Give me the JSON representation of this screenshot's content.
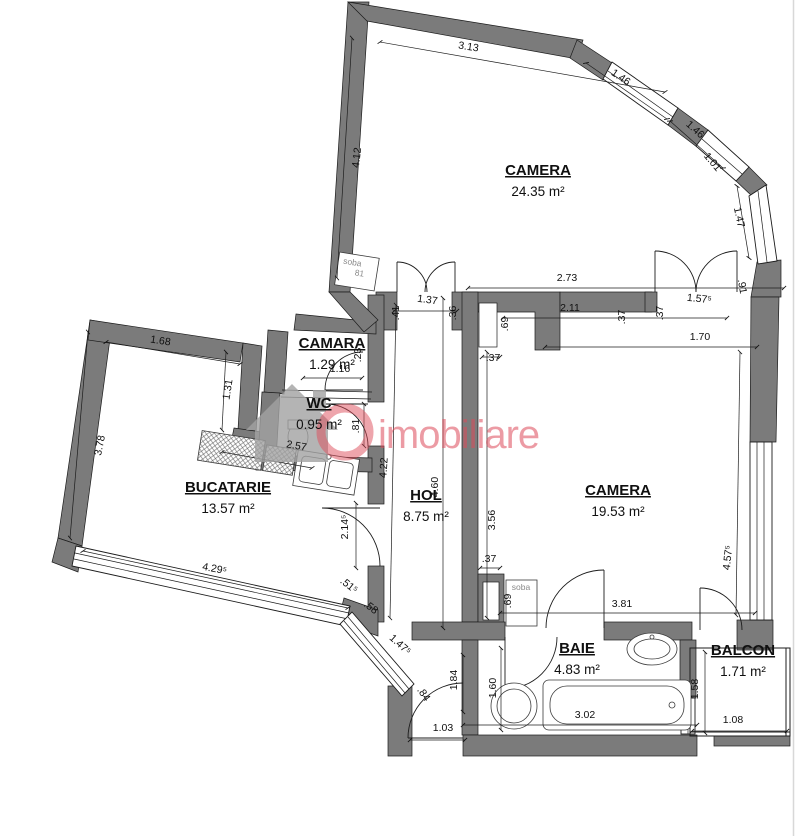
{
  "colors": {
    "wall": "#7b7b7b",
    "line": "#1c1c1c",
    "wm": "#de4b5a",
    "wmhouse": "#a2a2a2",
    "border": "#d8d8d8"
  },
  "plan": {
    "rooms": [
      {
        "name": "CAMERA",
        "area": "24.35 m²",
        "cx": 538,
        "cy": 175
      },
      {
        "name": "CAMARA",
        "area": "1.29 m²",
        "cx": 332,
        "cy": 348
      },
      {
        "name": "WC",
        "area": "0.95 m²",
        "cx": 319,
        "cy": 408
      },
      {
        "name": "BUCATARIE",
        "area": "13.57 m²",
        "cx": 228,
        "cy": 492
      },
      {
        "name": "HOL",
        "area": "8.75 m²",
        "cx": 426,
        "cy": 500
      },
      {
        "name": "CAMERA",
        "area": "19.53 m²",
        "cx": 618,
        "cy": 495
      },
      {
        "name": "BAIE",
        "area": "4.83 m²",
        "cx": 577,
        "cy": 653
      },
      {
        "name": "BALCON",
        "area": "1.71 m²",
        "cx": 743,
        "cy": 655
      }
    ],
    "dimensions": [
      {
        "v": "3.13",
        "x": 468,
        "y": 50,
        "r": 9
      },
      {
        "v": "4.12",
        "x": 360,
        "y": 158,
        "r": -84
      },
      {
        "v": "1.46",
        "x": 619,
        "y": 80,
        "r": 34
      },
      {
        "v": "1.46",
        "x": 693,
        "y": 132,
        "r": 42
      },
      {
        "v": "1.01",
        "x": 710,
        "y": 164,
        "r": 50
      },
      {
        "v": "1.47",
        "x": 736,
        "y": 218,
        "r": 78
      },
      {
        "v": ".91",
        "x": 739,
        "y": 287,
        "r": 80
      },
      {
        "v": "2.73",
        "x": 567,
        "y": 281,
        "r": 0
      },
      {
        "v": "1.37",
        "x": 427,
        "y": 303,
        "r": 8
      },
      {
        "v": ".41",
        "x": 399,
        "y": 313,
        "r": -90
      },
      {
        "v": ".36",
        "x": 456,
        "y": 313,
        "r": -90
      },
      {
        "v": "2.11",
        "x": 570,
        "y": 311,
        "r": 0
      },
      {
        "v": ".69",
        "x": 508,
        "y": 324,
        "r": -90
      },
      {
        "v": ".37",
        "x": 625,
        "y": 317,
        "r": -90
      },
      {
        "v": ".37",
        "x": 663,
        "y": 313,
        "r": -90
      },
      {
        "v": "1.57⁵",
        "x": 699,
        "y": 302,
        "r": 6
      },
      {
        "v": "1.70",
        "x": 700,
        "y": 340,
        "r": 0
      },
      {
        "v": ".37",
        "x": 493,
        "y": 361,
        "r": 0
      },
      {
        "v": "3.56",
        "x": 495,
        "y": 520,
        "r": -90
      },
      {
        "v": "4.57⁵",
        "x": 731,
        "y": 558,
        "r": -84
      },
      {
        "v": "3.81",
        "x": 622,
        "y": 607,
        "r": 0
      },
      {
        "v": ".37",
        "x": 489,
        "y": 562,
        "r": 0
      },
      {
        "v": ".69",
        "x": 511,
        "y": 601,
        "r": -90
      },
      {
        "v": "1.68",
        "x": 160,
        "y": 344,
        "r": 9
      },
      {
        "v": "1.31",
        "x": 231,
        "y": 390,
        "r": -81
      },
      {
        "v": "3.78",
        "x": 103,
        "y": 446,
        "r": -79
      },
      {
        "v": "2.57",
        "x": 296,
        "y": 449,
        "r": 10
      },
      {
        "v": "4.29⁵",
        "x": 214,
        "y": 572,
        "r": 11
      },
      {
        "v": "2.14⁵",
        "x": 348,
        "y": 527,
        "r": -90
      },
      {
        "v": ".51⁵",
        "x": 347,
        "y": 588,
        "r": 38
      },
      {
        "v": ".58",
        "x": 369,
        "y": 610,
        "r": 38
      },
      {
        "v": "1.47⁵",
        "x": 398,
        "y": 647,
        "r": 42
      },
      {
        "v": ".84",
        "x": 421,
        "y": 696,
        "r": 55
      },
      {
        "v": "1.03",
        "x": 443,
        "y": 731,
        "r": 0
      },
      {
        "v": "1.84",
        "x": 457,
        "y": 680,
        "r": -90
      },
      {
        "v": "1.60",
        "x": 496,
        "y": 688,
        "r": -90
      },
      {
        "v": "3.02",
        "x": 585,
        "y": 718,
        "r": 0
      },
      {
        "v": "1.58",
        "x": 698,
        "y": 689,
        "r": -90
      },
      {
        "v": "1.08",
        "x": 733,
        "y": 723,
        "r": 0
      },
      {
        "v": "4.22",
        "x": 387,
        "y": 468,
        "r": -86
      },
      {
        "v": "4.60",
        "x": 438,
        "y": 487,
        "r": -90
      },
      {
        "v": "1.16",
        "x": 340,
        "y": 372,
        "r": 0
      },
      {
        "v": ".23",
        "x": 361,
        "y": 355,
        "r": -90
      },
      {
        "v": ".81",
        "x": 359,
        "y": 426,
        "r": -90
      }
    ],
    "fixtures": [
      {
        "v": "soba",
        "x": 352,
        "y": 265,
        "r": 9
      },
      {
        "v": "81",
        "x": 359,
        "y": 276,
        "r": 9
      },
      {
        "v": "soba",
        "x": 521,
        "y": 590,
        "r": 0
      }
    ],
    "watermark": {
      "text": "imobiliare"
    }
  }
}
